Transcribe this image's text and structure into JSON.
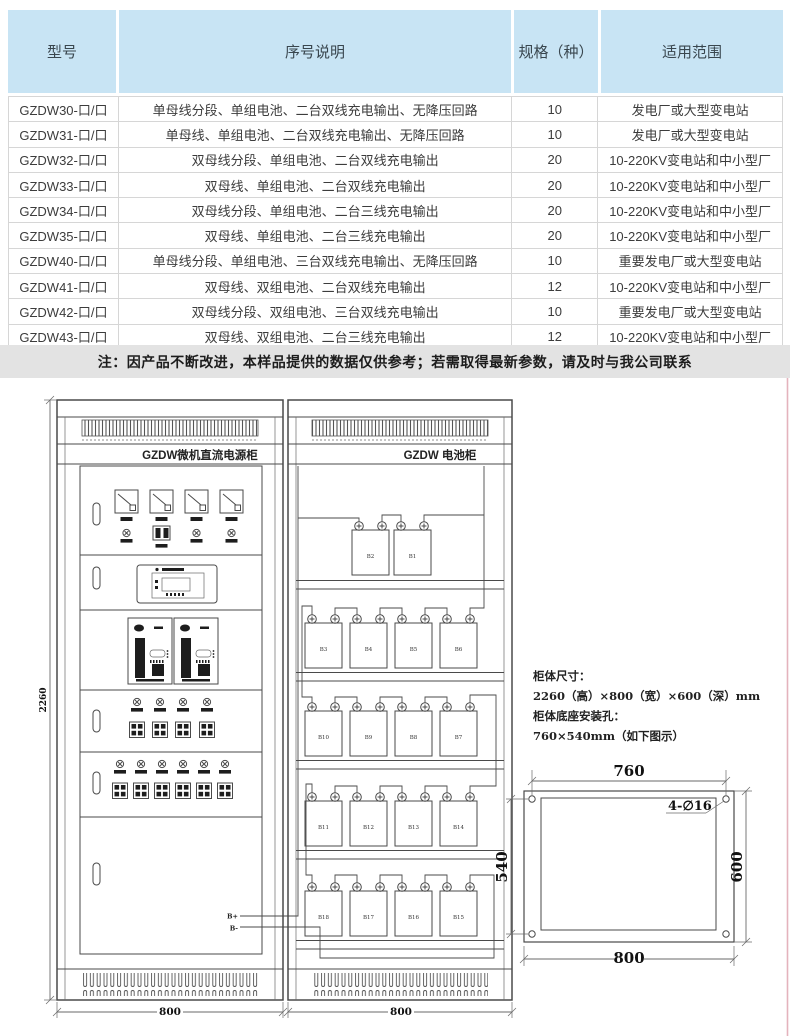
{
  "page": {
    "bg": "#ffffff",
    "accent_pink": "#e4b3bd",
    "header_bg": "#c8e4f4",
    "note_bg": "#e3e3e3",
    "line_color": "#4a4a4a"
  },
  "table": {
    "headers": {
      "model": "型号",
      "desc": "序号说明",
      "spec": "规格（种）",
      "scope": "适用范围"
    },
    "rows": [
      {
        "model": "GZDW30-口/口",
        "desc": "单母线分段、单组电池、二台双线充电输出、无降压回路",
        "spec": "10",
        "scope": "发电厂或大型变电站"
      },
      {
        "model": "GZDW31-口/口",
        "desc": "单母线、单组电池、二台双线充电输出、无降压回路",
        "spec": "10",
        "scope": "发电厂或大型变电站"
      },
      {
        "model": "GZDW32-口/口",
        "desc": "双母线分段、单组电池、二台双线充电输出",
        "spec": "20",
        "scope": "10-220KV变电站和中小型厂"
      },
      {
        "model": "GZDW33-口/口",
        "desc": "双母线、单组电池、二台双线充电输出",
        "spec": "20",
        "scope": "10-220KV变电站和中小型厂"
      },
      {
        "model": "GZDW34-口/口",
        "desc": "双母线分段、单组电池、二台三线充电输出",
        "spec": "20",
        "scope": "10-220KV变电站和中小型厂"
      },
      {
        "model": "GZDW35-口/口",
        "desc": "双母线、单组电池、二台三线充电输出",
        "spec": "20",
        "scope": "10-220KV变电站和中小型厂"
      },
      {
        "model": "GZDW40-口/口",
        "desc": "单母线分段、单组电池、三台双线充电输出、无降压回路",
        "spec": "10",
        "scope": "重要发电厂或大型变电站"
      },
      {
        "model": "GZDW41-口/口",
        "desc": "双母线、双组电池、二台双线充电输出",
        "spec": "12",
        "scope": "10-220KV变电站和中小型厂"
      },
      {
        "model": "GZDW42-口/口",
        "desc": "双母线分段、双组电池、三台双线充电输出",
        "spec": "10",
        "scope": "重要发电厂或大型变电站"
      },
      {
        "model": "GZDW43-口/口",
        "desc": "双母线、双组电池、二台三线充电输出",
        "spec": "12",
        "scope": "10-220KV变电站和中小型厂"
      }
    ]
  },
  "note": "注：因产品不断改进，本样品提供的数据仅供参考；若需取得最新参数，请及时与我公司联系",
  "drawing": {
    "power_cabinet": {
      "title": "GZDW微机直流电源柜",
      "width_label": "800"
    },
    "battery_cabinet": {
      "title": "GZDW 电池柜",
      "width_label": "800",
      "battery_rows": [
        [
          "B2",
          "B1"
        ],
        [
          "B3",
          "B4",
          "B5",
          "B6"
        ],
        [
          "B10",
          "B9",
          "B8",
          "B7"
        ],
        [
          "B11",
          "B12",
          "B13",
          "B14"
        ],
        [
          "B18",
          "B17",
          "B16",
          "B15"
        ]
      ],
      "terminal_pos": "B+",
      "terminal_neg": "B-"
    },
    "height_label": "2260",
    "spec_text": {
      "line1": "柜体尺寸：",
      "line2": "2260（高）×800（宽）×600（深）mm",
      "line3": "柜体底座安装孔：",
      "line4": "760×540mm（如下图示）"
    },
    "mount_diagram": {
      "top": "760",
      "left": "540",
      "right": "600",
      "bottom": "800",
      "holes_label": "4-∅16"
    }
  }
}
